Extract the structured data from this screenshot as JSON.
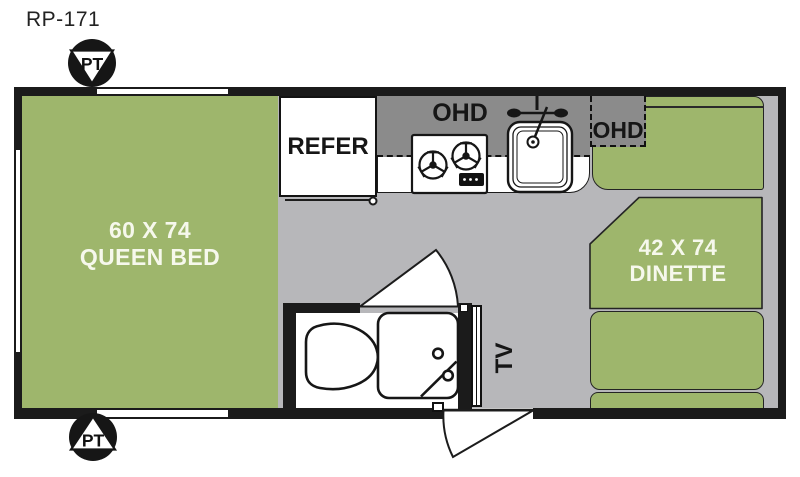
{
  "plan": {
    "model": "RP-171",
    "areas": {
      "queen_bed": {
        "size": "60 X 74",
        "name": "QUEEN BED"
      },
      "dinette": {
        "size": "42 X 74",
        "name": "DINETTE"
      },
      "refrigerator": "REFER",
      "overhead_kitchen": "OHD",
      "overhead_dinette": "OHD",
      "tv": "TV"
    },
    "markers": {
      "propane_front": "PT",
      "propane_rear": "PT"
    },
    "icons": {
      "propane_tank": "triangle-in-circle",
      "stove": "two-burner-cooktop",
      "sink": "single-basin-with-faucet",
      "toilet": "toilet-top-view",
      "shower": "shower-pan-with-knobs",
      "door_swing": "quarter-arc-wedge",
      "window": "thin-double-line-wall-gap"
    }
  },
  "colors": {
    "green": "#9eb66c",
    "floor_gray": "#b7b7ba",
    "counter_gray": "#8b8b8b",
    "wall_black": "#1b1b1b",
    "text_light": "#f6f8ec"
  }
}
